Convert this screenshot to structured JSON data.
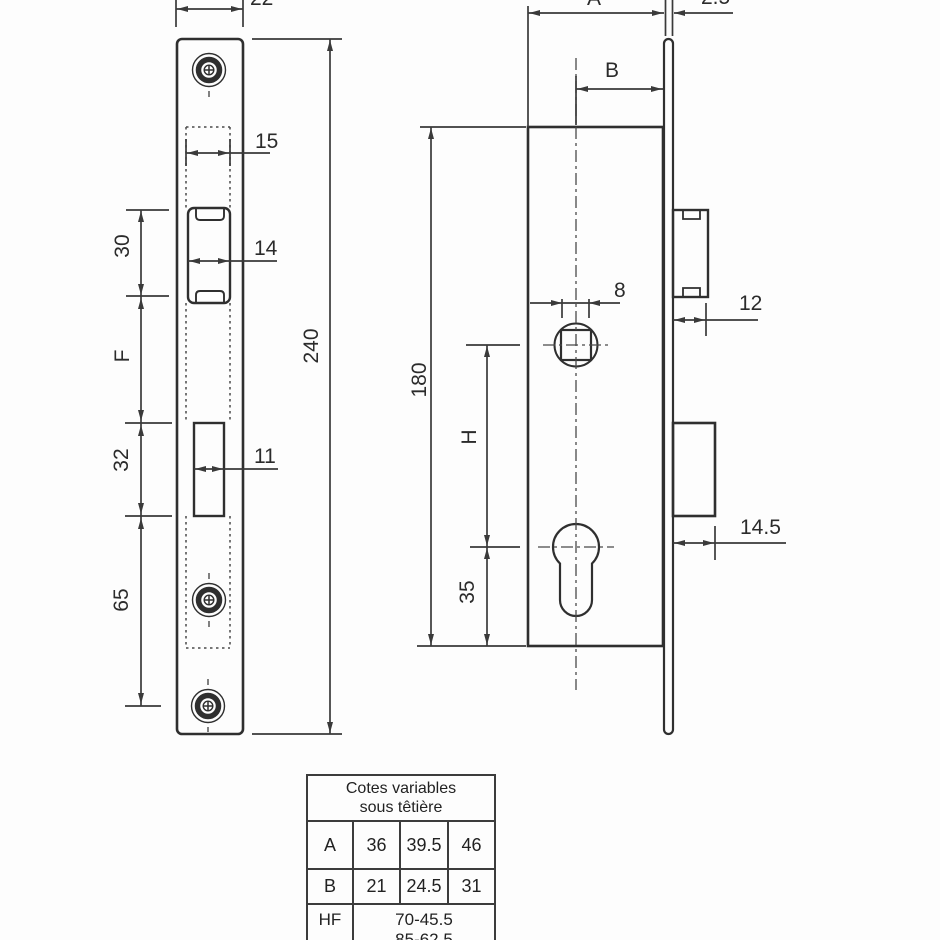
{
  "front_view": {
    "d22": "22",
    "d15": "15",
    "d30": "30",
    "d14": "14",
    "dF": "F",
    "d32": "32",
    "d11": "11",
    "d65": "65",
    "d240": "240"
  },
  "side_view": {
    "dA": "A",
    "d2_5": "2.5",
    "dB": "B",
    "d8": "8",
    "d12": "12",
    "d180": "180",
    "dH": "H",
    "d35": "35",
    "d14_5": "14.5"
  },
  "table": {
    "title_line1": "Cotes variables",
    "title_line2": "sous têtière",
    "row_a_label": "A",
    "row_a": [
      "36",
      "39.5",
      "46"
    ],
    "row_b_label": "B",
    "row_b": [
      "21",
      "24.5",
      "31"
    ],
    "row_hf_label": "HF",
    "row_hf_line1": "70-45.5",
    "row_hf_line2": "85-62.5"
  }
}
